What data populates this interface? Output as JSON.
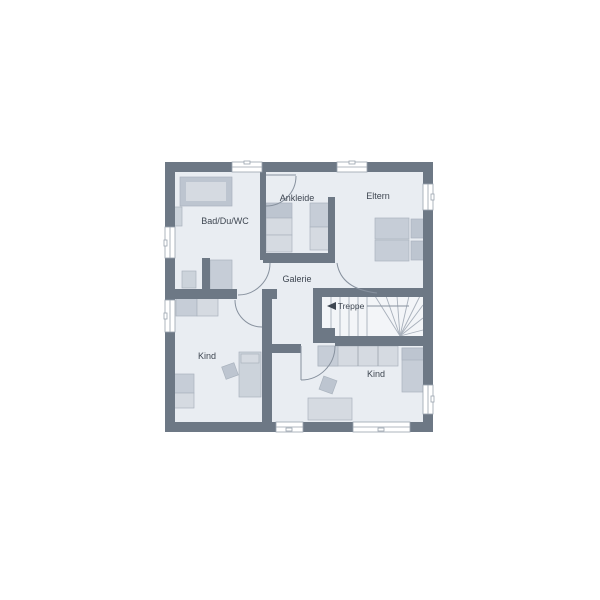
{
  "floorplan": {
    "rooms": {
      "bathroom": {
        "label": "Bad/Du/WC"
      },
      "dressing": {
        "label": "Ankleide"
      },
      "parents": {
        "label": "Eltern"
      },
      "gallery": {
        "label": "Galerie"
      },
      "stairs": {
        "label": "Treppe"
      },
      "child_left": {
        "label": "Kind"
      },
      "child_right": {
        "label": "Kind"
      }
    },
    "colors": {
      "background": "#ffffff",
      "wall": "#6d7885",
      "floor": "#e9edf2",
      "stair_floor": "#f3f5f8",
      "furniture": "#ccd3db",
      "furniture_dark": "#bdc5d0",
      "furniture_light": "#d5dae1",
      "accent_gray": "#c6cdd7",
      "line": "#87919e",
      "text": "#3e4651"
    }
  }
}
